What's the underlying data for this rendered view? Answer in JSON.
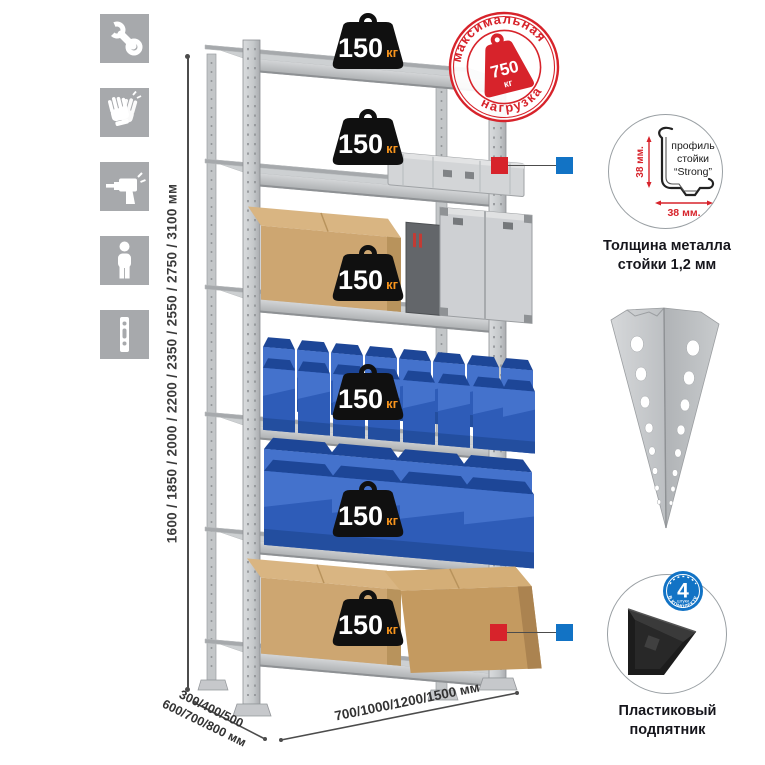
{
  "sidebar": {
    "icons": [
      {
        "name": "wrench-icon"
      },
      {
        "name": "work-gloves-icon"
      },
      {
        "name": "drill-icon"
      },
      {
        "name": "person-icon"
      },
      {
        "name": "rack-post-icon"
      }
    ]
  },
  "height_dimension": {
    "label": "1600 / 1850 / 2000 / 2200 / 2350 / 2550 / 2750 / 3100 мм"
  },
  "rack": {
    "badges": [
      {
        "value": "150",
        "unit": "кг"
      },
      {
        "value": "150",
        "unit": "кг"
      },
      {
        "value": "150",
        "unit": "кг"
      },
      {
        "value": "150",
        "unit": "кг"
      },
      {
        "value": "150",
        "unit": "кг"
      },
      {
        "value": "150",
        "unit": "кг"
      }
    ]
  },
  "stamp": {
    "arc_top": "максимальная",
    "arc_bottom": "нагрузка",
    "value": "750",
    "unit": "кг"
  },
  "profile_detail": {
    "line1": "профиль",
    "line2": "стойки",
    "line3": "“Strong”",
    "dim_vertical": "38 мм.",
    "dim_horizontal": "38 мм.",
    "caption_line1": "Толщина металла",
    "caption_line2": "стойки 1,2 мм"
  },
  "foot_detail": {
    "badge_number": "4",
    "badge_sub": "штуки",
    "badge_arc": "В КОМПЛЕКТЕ",
    "caption_line1": "Пластиковый",
    "caption_line2": "подпятник"
  },
  "bottom_dimensions": {
    "depth_line1": "300/400/500",
    "depth_line2": "600/700/800 мм",
    "width_label": "700/1000/1200/1500 мм"
  },
  "colors": {
    "stamp_red": "#d7232b",
    "marker_blue": "#1273c5",
    "bin_blue": "#2e5cb8",
    "kg_orange": "#f7941d",
    "weight_black": "#101010",
    "metal_gray": "#c9cbce",
    "icon_gray": "#a7a9ac",
    "cardboard_tan": "#cda671"
  }
}
